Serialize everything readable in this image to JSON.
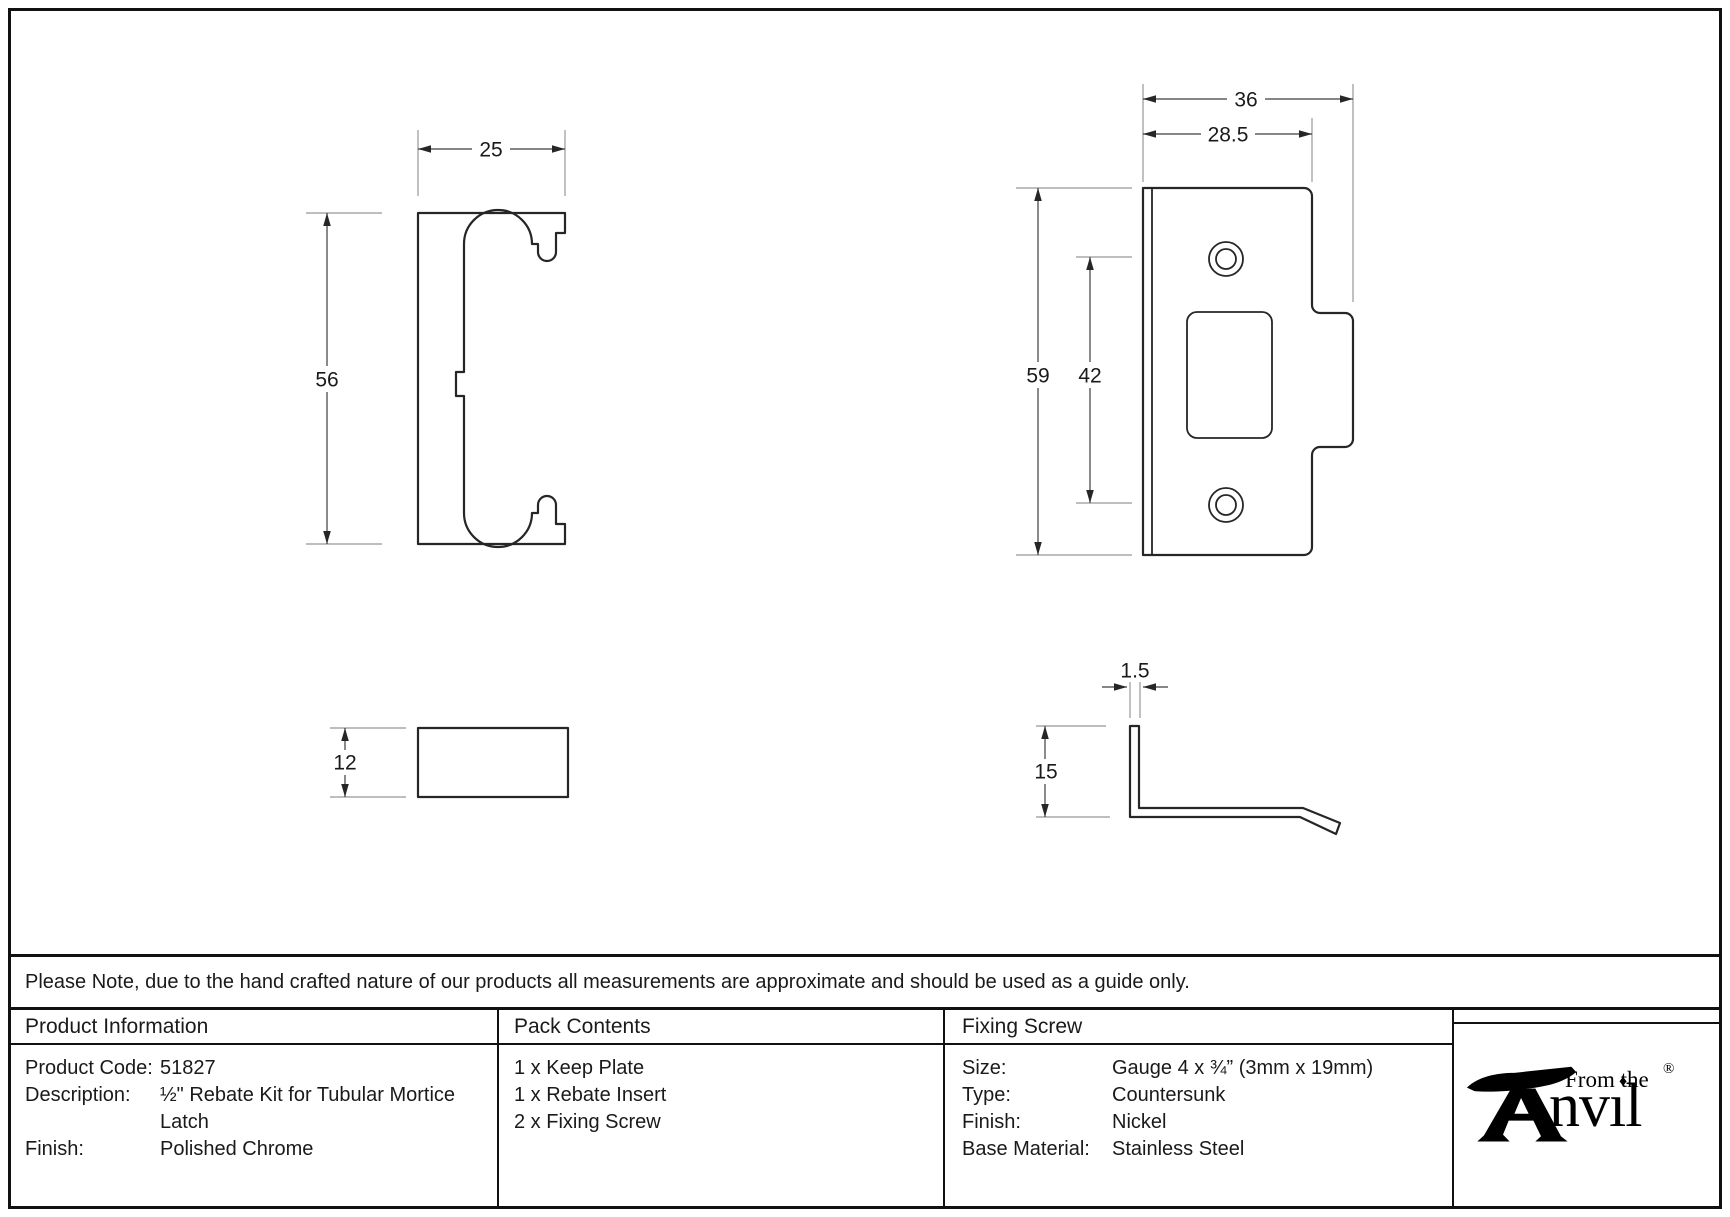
{
  "drawing": {
    "insert_front": {
      "width": "25",
      "height": "56"
    },
    "keep_plate": {
      "overall_width": "36",
      "plate_width": "28.5",
      "height": "59",
      "hole_spacing": "42"
    },
    "insert_side": {
      "thickness": "12"
    },
    "keep_plate_side": {
      "lip_thickness": "1.5",
      "lip_height": "15"
    }
  },
  "note": "Please Note, due to the hand crafted nature of our products all measurements are approximate and should be used as a guide only.",
  "table": {
    "product_information": {
      "header": "Product Information",
      "rows": [
        {
          "label": "Product Code:",
          "value": "51827"
        },
        {
          "label": "Description:",
          "value": "½\" Rebate Kit for Tubular Mortice Latch"
        },
        {
          "label": "Finish:",
          "value": "Polished Chrome"
        }
      ]
    },
    "pack_contents": {
      "header": "Pack Contents",
      "items": [
        "1 x Keep Plate",
        "1 x Rebate Insert",
        "2 x Fixing Screw"
      ]
    },
    "fixing_screw": {
      "header": "Fixing Screw",
      "rows": [
        {
          "label": "Size:",
          "value": "Gauge 4 x ¾” (3mm x 19mm)"
        },
        {
          "label": "Type:",
          "value": "Countersunk"
        },
        {
          "label": "Finish:",
          "value": "Nickel"
        },
        {
          "label": "Base Material:",
          "value": "Stainless Steel"
        }
      ]
    }
  },
  "logo": {
    "tagline": "From the",
    "brand": "Anvil",
    "brand_display": "nvıl",
    "registered": "®",
    "diamond": "♦"
  },
  "colors": {
    "line": "#262626",
    "dim_line": "#3d3d3d",
    "ext_line": "#979797",
    "text": "#1a1a1a",
    "border": "#111111"
  }
}
